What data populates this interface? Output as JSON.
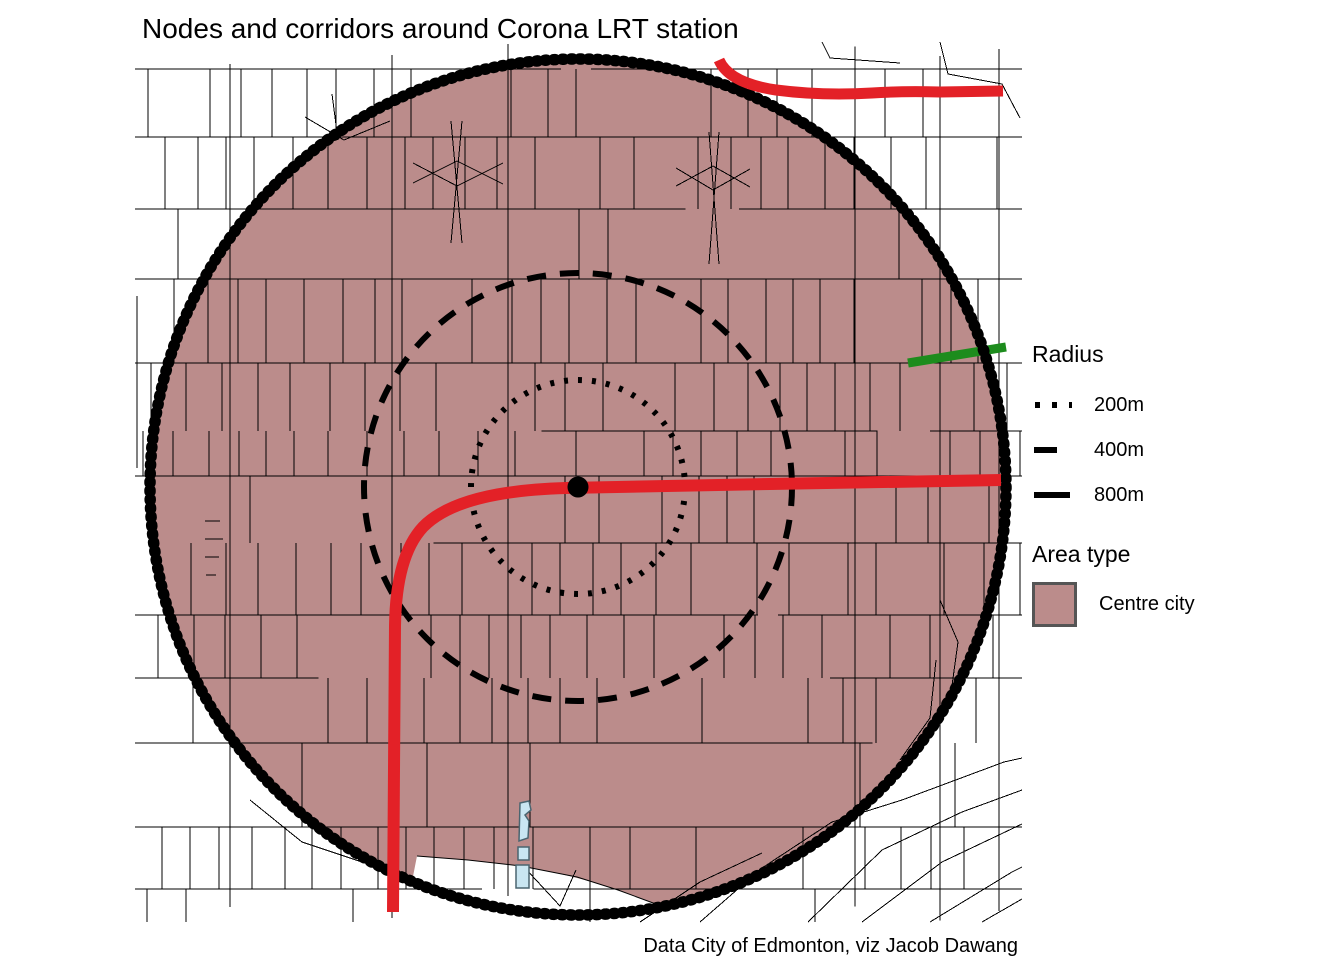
{
  "title": "Nodes and corridors around Corona LRT station",
  "caption": "Data City of Edmonton, viz Jacob Dawang",
  "legend": {
    "radius": {
      "title": "Radius",
      "items": [
        {
          "label": "200m",
          "style": "dotted"
        },
        {
          "label": "400m",
          "style": "dashed"
        },
        {
          "label": "800m",
          "style": "solid"
        }
      ]
    },
    "area_type": {
      "title": "Area type",
      "items": [
        {
          "label": "Centre city",
          "color": "#bb8c8b"
        }
      ]
    }
  },
  "colors": {
    "background": "#ffffff",
    "fill": "#bb8c8b",
    "street": "#000000",
    "ring": "#000000",
    "boundary": "#000000",
    "red": "#e32127",
    "green": "#1d8c1d",
    "water_fill": "#c9e6f2",
    "water_stroke": "#4a6570",
    "swatch_border": "#555555"
  },
  "map": {
    "center": {
      "x": 578,
      "y": 487
    },
    "station_dot_radius": 10.5,
    "rings": [
      {
        "name": "radius-200m",
        "r": 107,
        "stroke_width": 6,
        "dash": "4 10"
      },
      {
        "name": "radius-400m",
        "r": 214,
        "stroke_width": 6,
        "dash": "19 14"
      }
    ],
    "boundary": {
      "name": "radius-800m",
      "r": 428,
      "stroke_width": 5.5,
      "rough_width": 11.5,
      "rough_dash": "1.5 7.2"
    },
    "corridors": [
      {
        "name": "lrt-corridor-main",
        "path": "M 1001 480 L 770 484 L 566 488 Q 458 491 423 527 Q 396 556 395 626 L 393 912",
        "width": 12
      },
      {
        "name": "lrt-corridor-north",
        "path": "M 719 60 Q 729 83 776 90 Q 822 96 872 93 Q 902 91 940 92 L 1003 91",
        "width": 11
      }
    ],
    "green_segment": {
      "x1": 908,
      "y1": 363,
      "x2": 1006,
      "y2": 347,
      "width": 9
    },
    "water_path": "M 520 803 L 529 801 L 531 810 L 525 815 L 529 821 L 528 838 L 519 841 Z M 518 847 L 529 847 L 529 860 L 518 860 Z M 516 865 L 529 865 L 529 888 L 516 888 Z",
    "notch": {
      "fill_path": "M 406 912 L 417 856 Q 468 859 521 866 Q 577 876 618 890 Q 648 900 668 909 L 660 920 Q 520 929 410 918 Z",
      "edge_points": "417,856 468,860 521,866 577,877 618,890 664,907"
    },
    "streets": {
      "seed": 11,
      "x_min": 135,
      "x_max": 1022,
      "y_min": 42,
      "y_max": 922
    },
    "extra_streets": [
      [
        [
          940,
          42
        ],
        [
          948,
          74
        ],
        [
          1002,
          84
        ],
        [
          1020,
          118
        ]
      ],
      [
        [
          822,
          42
        ],
        [
          830,
          58
        ],
        [
          900,
          63
        ]
      ],
      [
        [
          305,
          117
        ],
        [
          344,
          140
        ],
        [
          390,
          121
        ]
      ],
      [
        [
          332,
          94
        ],
        [
          338,
          140
        ]
      ],
      [
        [
          413,
          183
        ],
        [
          457,
          161
        ],
        [
          503,
          184
        ]
      ],
      [
        [
          413,
          163
        ],
        [
          457,
          186
        ],
        [
          503,
          163
        ]
      ],
      [
        [
          451,
          121
        ],
        [
          462,
          243
        ]
      ],
      [
        [
          462,
          121
        ],
        [
          451,
          243
        ]
      ],
      [
        [
          676,
          186
        ],
        [
          713,
          166
        ],
        [
          750,
          187
        ]
      ],
      [
        [
          676,
          168
        ],
        [
          713,
          190
        ],
        [
          750,
          169
        ]
      ],
      [
        [
          709,
          132
        ],
        [
          719,
          264
        ]
      ],
      [
        [
          719,
          132
        ],
        [
          709,
          264
        ]
      ],
      [
        [
          137,
          296
        ],
        [
          137,
          468
        ]
      ],
      [
        [
          205,
          521
        ],
        [
          220,
          521
        ]
      ],
      [
        [
          205,
          539
        ],
        [
          223,
          539
        ]
      ],
      [
        [
          205,
          557
        ],
        [
          219,
          557
        ]
      ],
      [
        [
          206,
          575
        ],
        [
          216,
          575
        ]
      ],
      [
        [
          640,
          922
        ],
        [
          700,
          882
        ],
        [
          762,
          853
        ]
      ],
      [
        [
          700,
          922
        ],
        [
          762,
          868
        ],
        [
          832,
          822
        ],
        [
          902,
          800
        ],
        [
          1004,
          762
        ],
        [
          1022,
          758
        ]
      ],
      [
        [
          808,
          922
        ],
        [
          882,
          850
        ],
        [
          962,
          812
        ],
        [
          1022,
          790
        ]
      ],
      [
        [
          862,
          922
        ],
        [
          942,
          862
        ],
        [
          1022,
          824
        ]
      ],
      [
        [
          930,
          922
        ],
        [
          1012,
          872
        ],
        [
          1022,
          867
        ]
      ],
      [
        [
          982,
          922
        ],
        [
          1022,
          899
        ]
      ],
      [
        [
          900,
          760
        ],
        [
          930,
          718
        ],
        [
          936,
          660
        ]
      ],
      [
        [
          940,
          600
        ],
        [
          958,
          642
        ],
        [
          950,
          700
        ]
      ],
      [
        [
          525,
          868
        ],
        [
          560,
          906
        ],
        [
          576,
          870
        ]
      ],
      [
        [
          250,
          800
        ],
        [
          302,
          842
        ],
        [
          362,
          862
        ]
      ]
    ]
  }
}
